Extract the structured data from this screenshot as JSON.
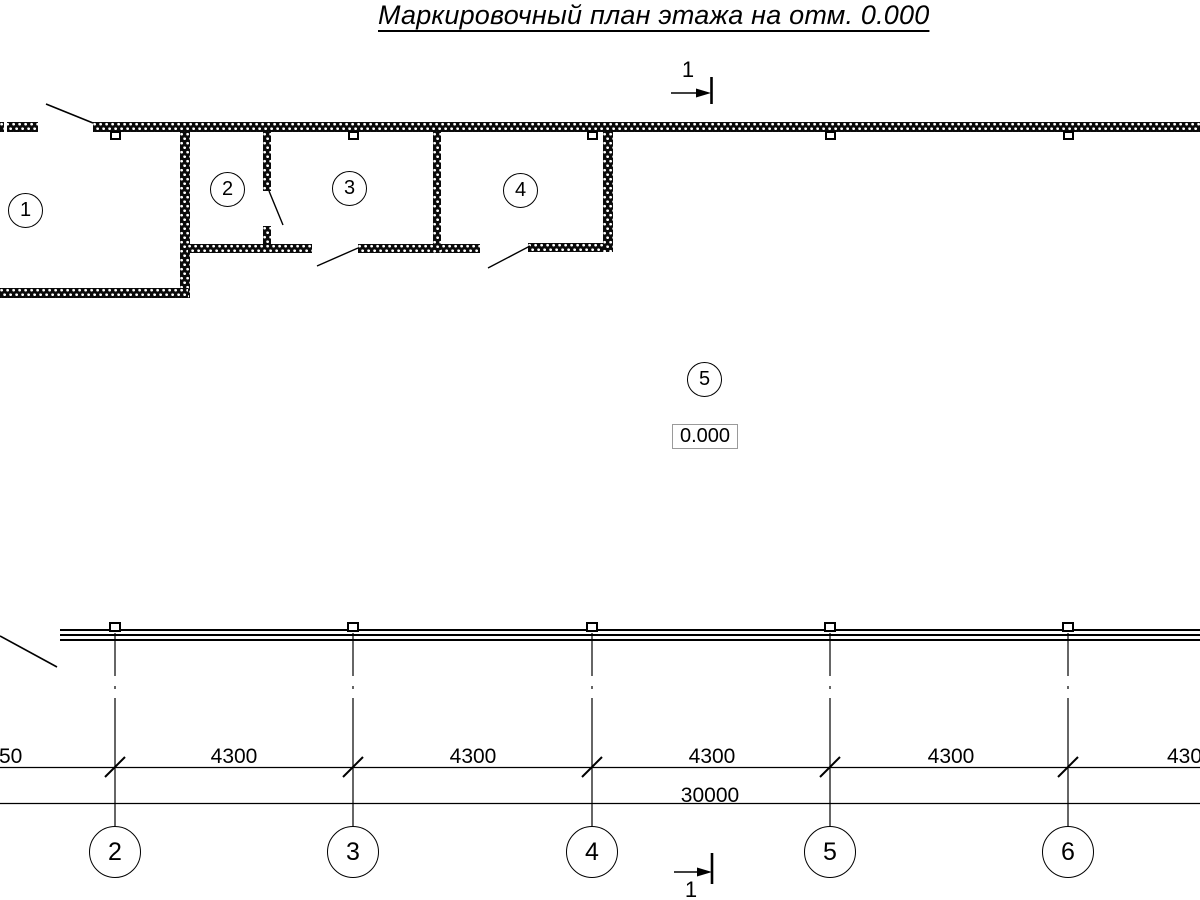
{
  "title": "Маркировочный план этажа на отм. 0.000",
  "colors": {
    "ink": "#000000",
    "paper": "#ffffff",
    "elevation_box_border": "#9a9a9a"
  },
  "plan": {
    "room_marks": [
      "1",
      "2",
      "3",
      "4",
      "5"
    ],
    "elevation_mark": "0.000"
  },
  "section_marks": {
    "top": "1",
    "bottom": "1"
  },
  "grid": {
    "axis_marks": [
      "2",
      "3",
      "4",
      "5",
      "6"
    ],
    "segment_dims": [
      "50",
      "4300",
      "4300",
      "4300",
      "4300",
      "4300"
    ],
    "total_dim": "30000"
  }
}
